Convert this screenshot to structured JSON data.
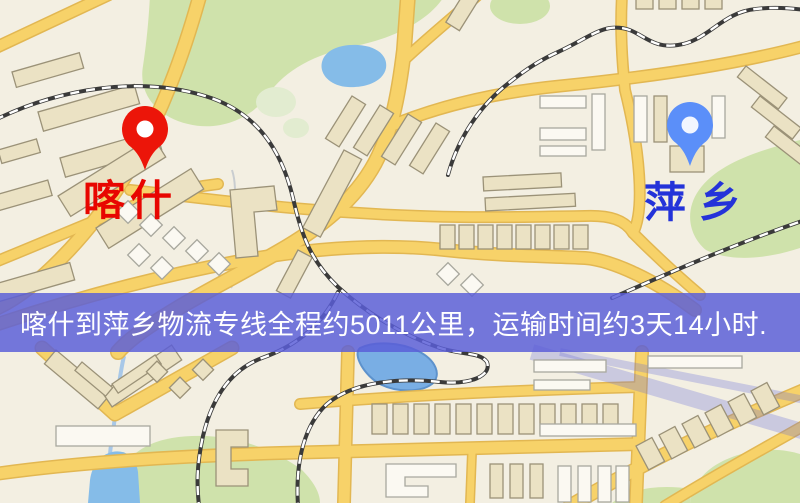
{
  "map": {
    "markers": [
      {
        "id": "kashgar",
        "label": "喀什",
        "pin_color": "#ec1509",
        "label_color": "#e80600"
      },
      {
        "id": "pingxiang",
        "label": "萍乡",
        "pin_color": "#5b8ff9",
        "label_color": "#2433d9"
      }
    ],
    "banner": {
      "text": "喀什到萍乡物流专线全程约5011公里，运输时间约3天14小时.",
      "bg_color": "#5a5ed8",
      "text_color": "#ffffff"
    },
    "palette": {
      "background": "#f3efe2",
      "road": "#f7d269",
      "road_casing": "#e2b752",
      "park": "#cfe2ab",
      "water": "#85bce8",
      "building": "#ebe2c4",
      "railway": "#3a3a3a"
    },
    "icons": {
      "red_pin": "map-pin",
      "blue_pin": "map-pin"
    }
  }
}
